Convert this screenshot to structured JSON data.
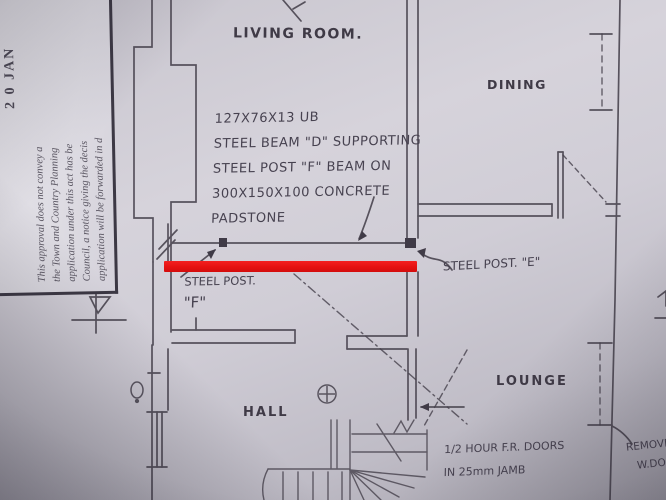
{
  "stamp": {
    "date": "2 0 JAN",
    "line1": "This approval does not convey a",
    "line2": "the Town and Country Planning",
    "line3": "application under this act has be",
    "line4": "Council, a notice giving the decis",
    "line5": "application will be forwarded in d"
  },
  "rooms": {
    "living": "LIVING ROOM.",
    "dining": "DINING",
    "lounge": "LOUNGE",
    "hall": "HALL"
  },
  "notes": {
    "beam_line1": "127X76X13 UB",
    "beam_line2": "STEEL BEAM \"D\" SUPPORTING",
    "beam_line3": "STEEL POST \"F\" BEAM ON",
    "beam_line4": "300X150X100 CONCRETE",
    "beam_line5": "PADSTONE",
    "post_f_label": "STEEL POST.",
    "post_f_letter": "\"F\"",
    "post_e_label": "STEEL POST. \"E\"",
    "fire_doors_line1": "1/2 HOUR F.R. DOORS",
    "fire_doors_line2": "IN 25mm JAMB",
    "remove_line1": "REMOVE",
    "remove_line2": "W.DORE"
  },
  "highlight": {
    "color": "#e51111"
  }
}
